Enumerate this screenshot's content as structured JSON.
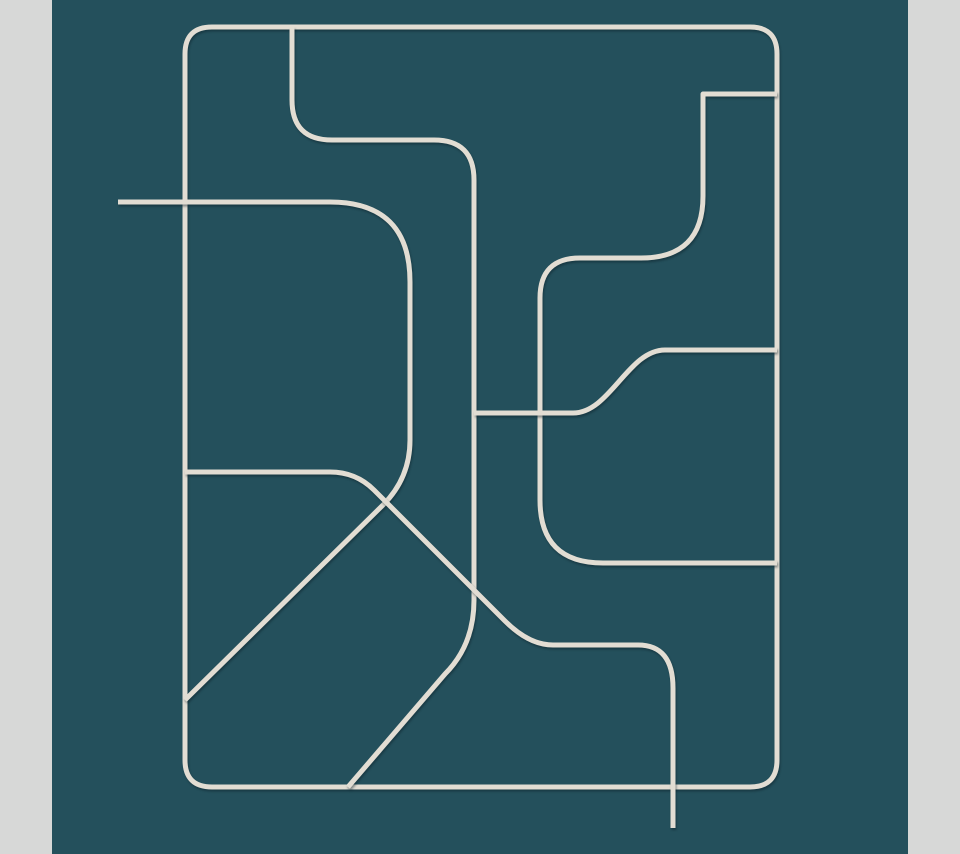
{
  "canvas": {
    "width": 960,
    "height": 854,
    "margin_bar_color": "#d7d8d7",
    "panel_color": "#24505c",
    "line_color": "#e2ddd3",
    "line_shadow_color": "rgba(10,32,40,0.45)",
    "line_width": 5,
    "panel": {
      "x": 52,
      "y": 0,
      "width": 856,
      "height": 854
    }
  },
  "artwork": {
    "title": "abstract-teal-line-art",
    "description": "Cream rounded pipe-like lines forming an abstract maze pattern on a dark teal panel with light gray side margins",
    "viewbox": "0 0 960 854",
    "paths": [
      {
        "name": "outer-rounded-rectangle",
        "d": "M 212 27 H 750 Q 777 27 777 54 V 760 Q 777 787 750 787 H 212 Q 185 787 185 760 V 54 Q 185 27 212 27 Z"
      },
      {
        "name": "top-hook-to-bottom-diagonal-line",
        "d": "M 292 27 V 100 Q 292 140 332 140 H 434 Q 474 140 474 180 V 600 Q 474 645 445 674 L 348 787"
      },
      {
        "name": "left-horizontal-to-diagonal-d-line",
        "d": "M 118 202 H 330 Q 410 202 410 282 V 440 Q 410 478 383 505 L 185 700"
      },
      {
        "name": "mid-horizontal-diagonal-tail-line",
        "d": "M 185 472 H 330 Q 356 472 374 490 L 505 621 Q 529 645 553 645 H 638 Q 673 645 673 688 V 828"
      },
      {
        "name": "right-zigzag-pipe-line",
        "d": "M 777 94 H 703 V 196 Q 703 258 641 258 H 580 Q 540 258 540 298 V 500 Q 540 563 603 563 H 777"
      },
      {
        "name": "center-s-curve-line",
        "d": "M 474 413 H 573 C 610 413 628 350 665 350 H 777"
      }
    ]
  }
}
